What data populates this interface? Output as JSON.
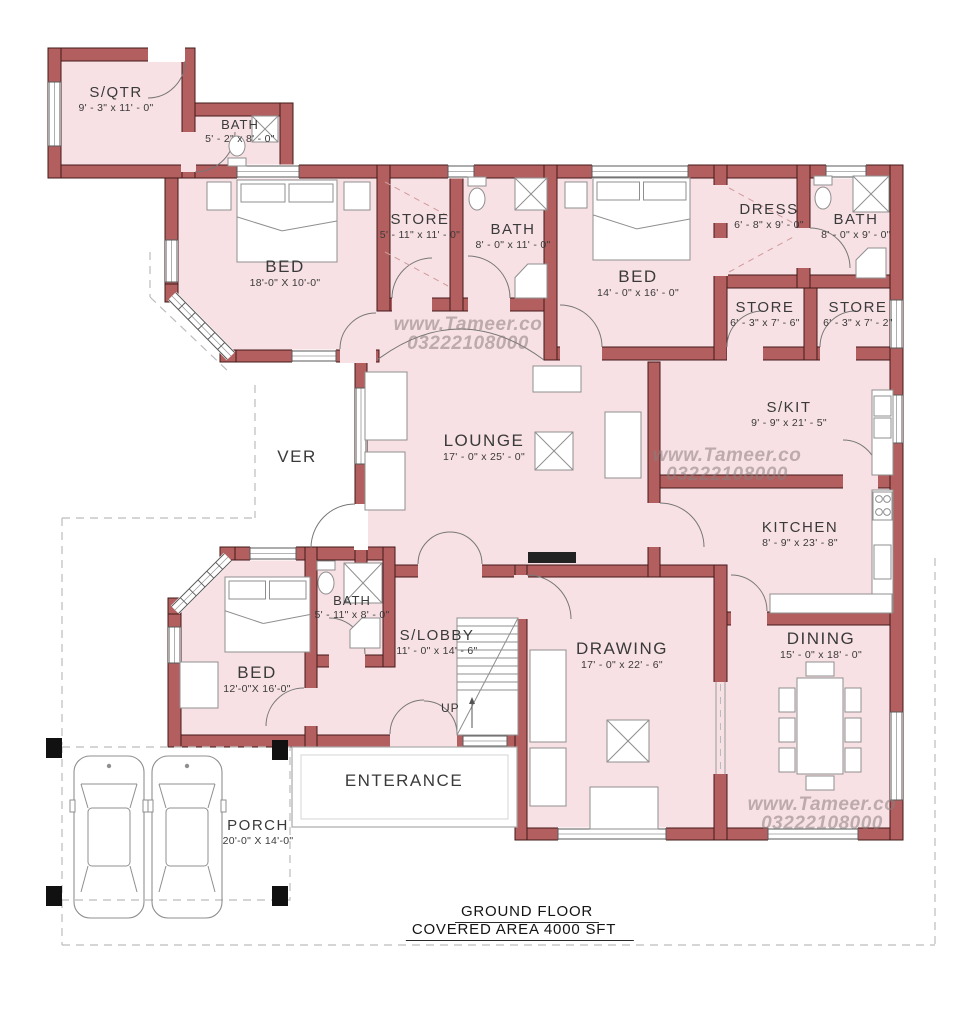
{
  "plan": {
    "title_line1": "GROUND FLOOR",
    "title_line2": "COVERED AREA  4000 SFT",
    "watermark": {
      "site": "www.Tameer.co",
      "phone": "03222108000"
    },
    "colors": {
      "wall_fill": "#b35f5f",
      "wall_outline": "#43181a",
      "room_fill": "#f8e1e4",
      "furniture_stroke": "#8f8f8f",
      "label_text": "#3a3a3a",
      "watermark_text": "#8a7e7e",
      "dash_line": "#bcbcbc",
      "column_black": "#111111"
    },
    "rooms": {
      "sqtr": {
        "name": "S/QTR",
        "dims": "9' - 3\" x 11' - 0\""
      },
      "bath_sqtr": {
        "name": "BATH",
        "dims": "5' - 2\" x 8' - 0\""
      },
      "bed1": {
        "name": "BED",
        "dims": "18'-0\" X 10'-0\""
      },
      "store1": {
        "name": "STORE",
        "dims": "5' - 11\" x 11' - 0\""
      },
      "bath2": {
        "name": "BATH",
        "dims": "8' - 0\" x 11' - 0\""
      },
      "bed2": {
        "name": "BED",
        "dims": "14' - 0\" x 16' - 0\""
      },
      "dress": {
        "name": "DRESS",
        "dims": "6' - 8\" x 9' - 0\""
      },
      "bath3": {
        "name": "BATH",
        "dims": "8' - 0\" x 9' - 0\""
      },
      "store2": {
        "name": "STORE",
        "dims": "6' - 3\" x 7' - 6\""
      },
      "store3": {
        "name": "STORE",
        "dims": "6' - 3\" x 7' - 2\""
      },
      "ver": {
        "name": "VER"
      },
      "lounge": {
        "name": "LOUNGE",
        "dims": "17' - 0\" x 25' - 0\""
      },
      "skit": {
        "name": "S/KIT",
        "dims": "9' - 9\" x 21' - 5\""
      },
      "kitchen": {
        "name": "KITCHEN",
        "dims": "8' - 9\" x 23' - 8\""
      },
      "bed3": {
        "name": "BED",
        "dims": "12'-0\"X 16'-0\""
      },
      "bath4": {
        "name": "BATH",
        "dims": "5' - 11\" x 8' - 0\""
      },
      "slobby": {
        "name": "S/LOBBY",
        "dims": "11' - 0\" x 14' - 6\""
      },
      "drawing": {
        "name": "DRAWING",
        "dims": "17' - 0\" x 22' - 6\""
      },
      "dining": {
        "name": "DINING",
        "dims": "15' - 0\" x 18' - 0\""
      },
      "enterance": {
        "name": "ENTERANCE"
      },
      "porch": {
        "name": "PORCH",
        "dims": "20'-0\" X 14'-0\""
      },
      "stairs": {
        "up_label": "UP"
      }
    }
  }
}
